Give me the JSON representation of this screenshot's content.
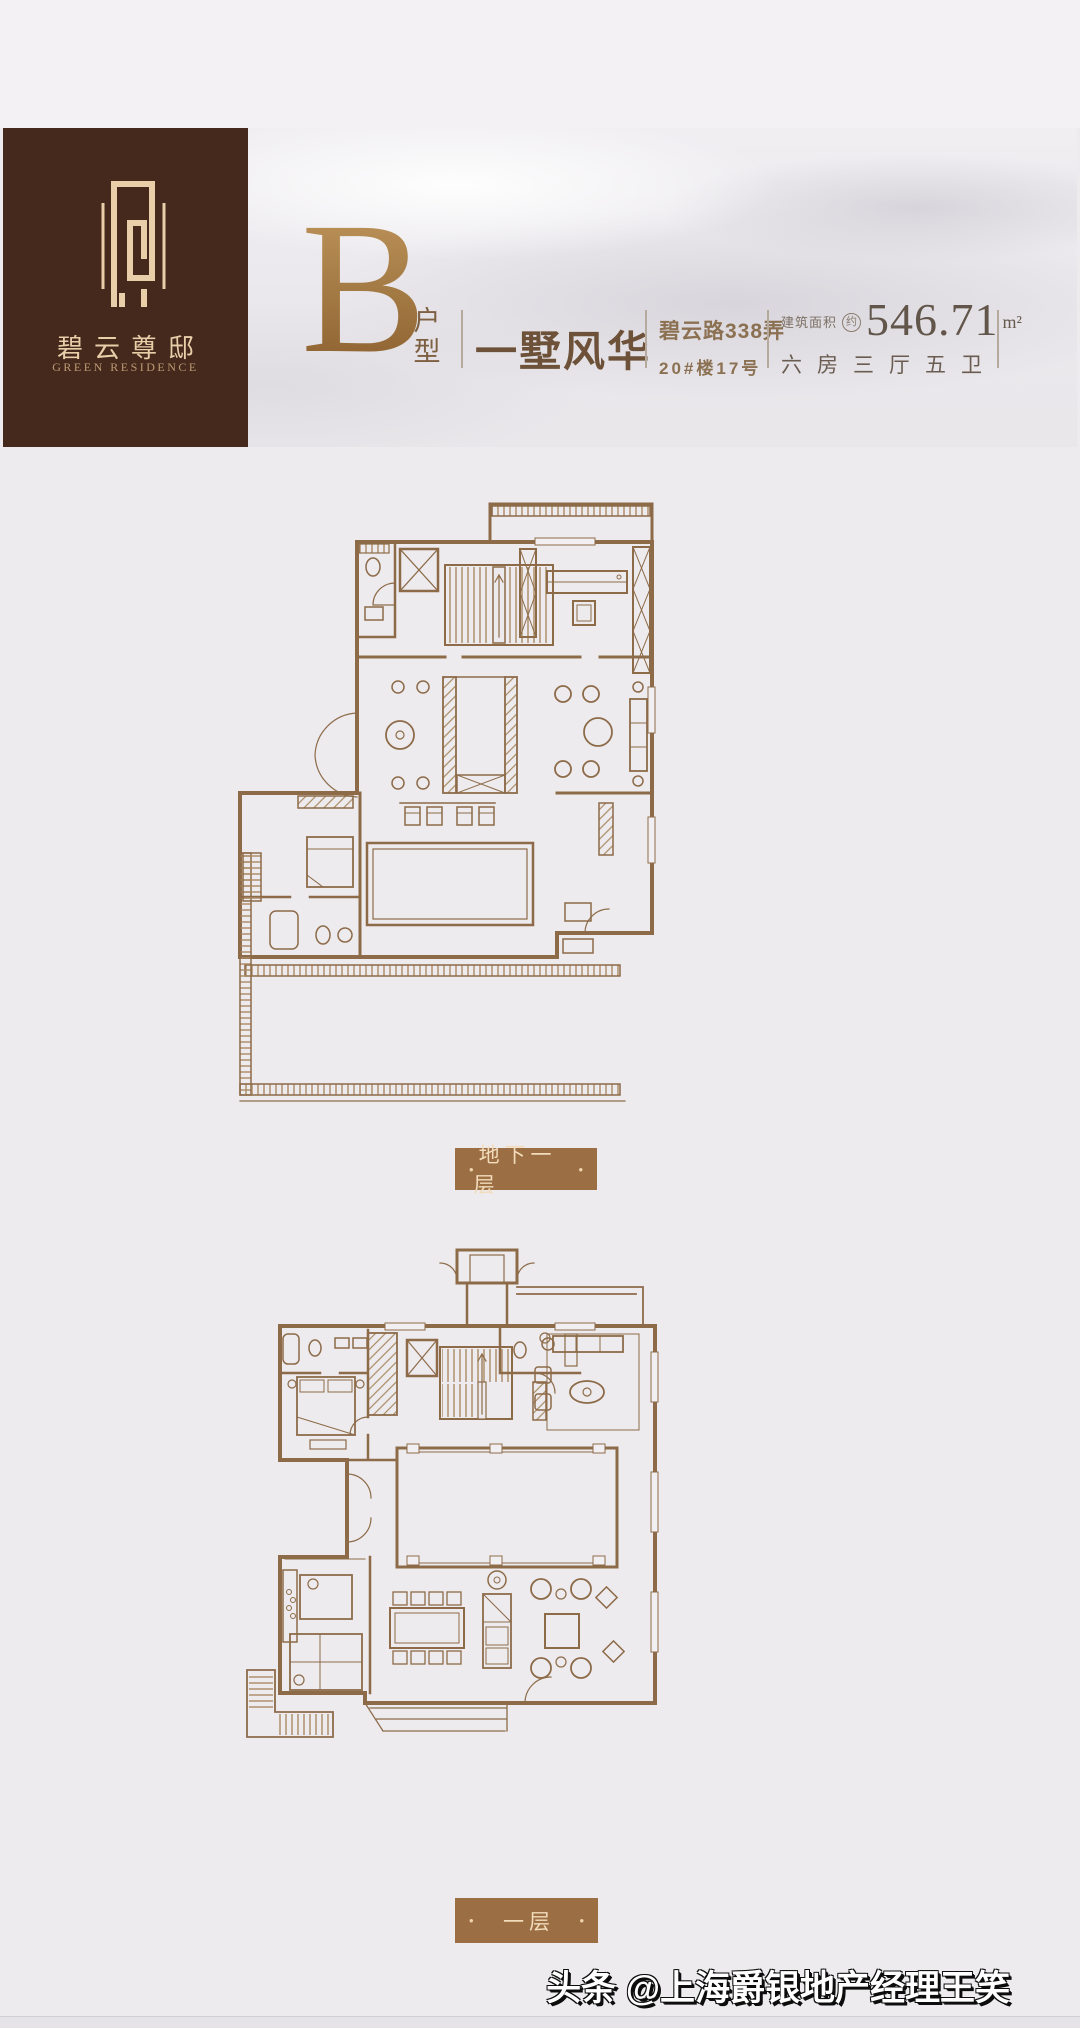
{
  "header": {
    "logo": {
      "brand_cn": "碧云尊邸",
      "brand_en": "GREEN RESIDENCE"
    },
    "unit_letter": "B",
    "unit_suffix": "户型",
    "slogan": "一墅风华",
    "address_line1": "碧云路338弄",
    "address_line2": "20#楼17号",
    "area_label": "建筑面积",
    "area_approx": "约",
    "area_value": "546.71",
    "area_unit": "m²",
    "layout": "六房三厅五卫"
  },
  "plans": [
    {
      "label": "地下一层"
    },
    {
      "label": "一层"
    }
  ],
  "badge_dot": "•",
  "watermark": "头条 @上海爵银地产经理王笑",
  "colors": {
    "page_bg": "#edebee",
    "logo_box": "#46291d",
    "logo_gold": "#e8cfa9",
    "bronze": "#a6793f",
    "slogan_brown": "#6d5138",
    "address_brown": "#8b7052",
    "area_taupe": "#665a4e",
    "badge_bg": "#9c6e44",
    "badge_text": "#f2dcbb",
    "plan_line": "#8d6b49",
    "plan_wall_fill": "#d9bf9d"
  }
}
